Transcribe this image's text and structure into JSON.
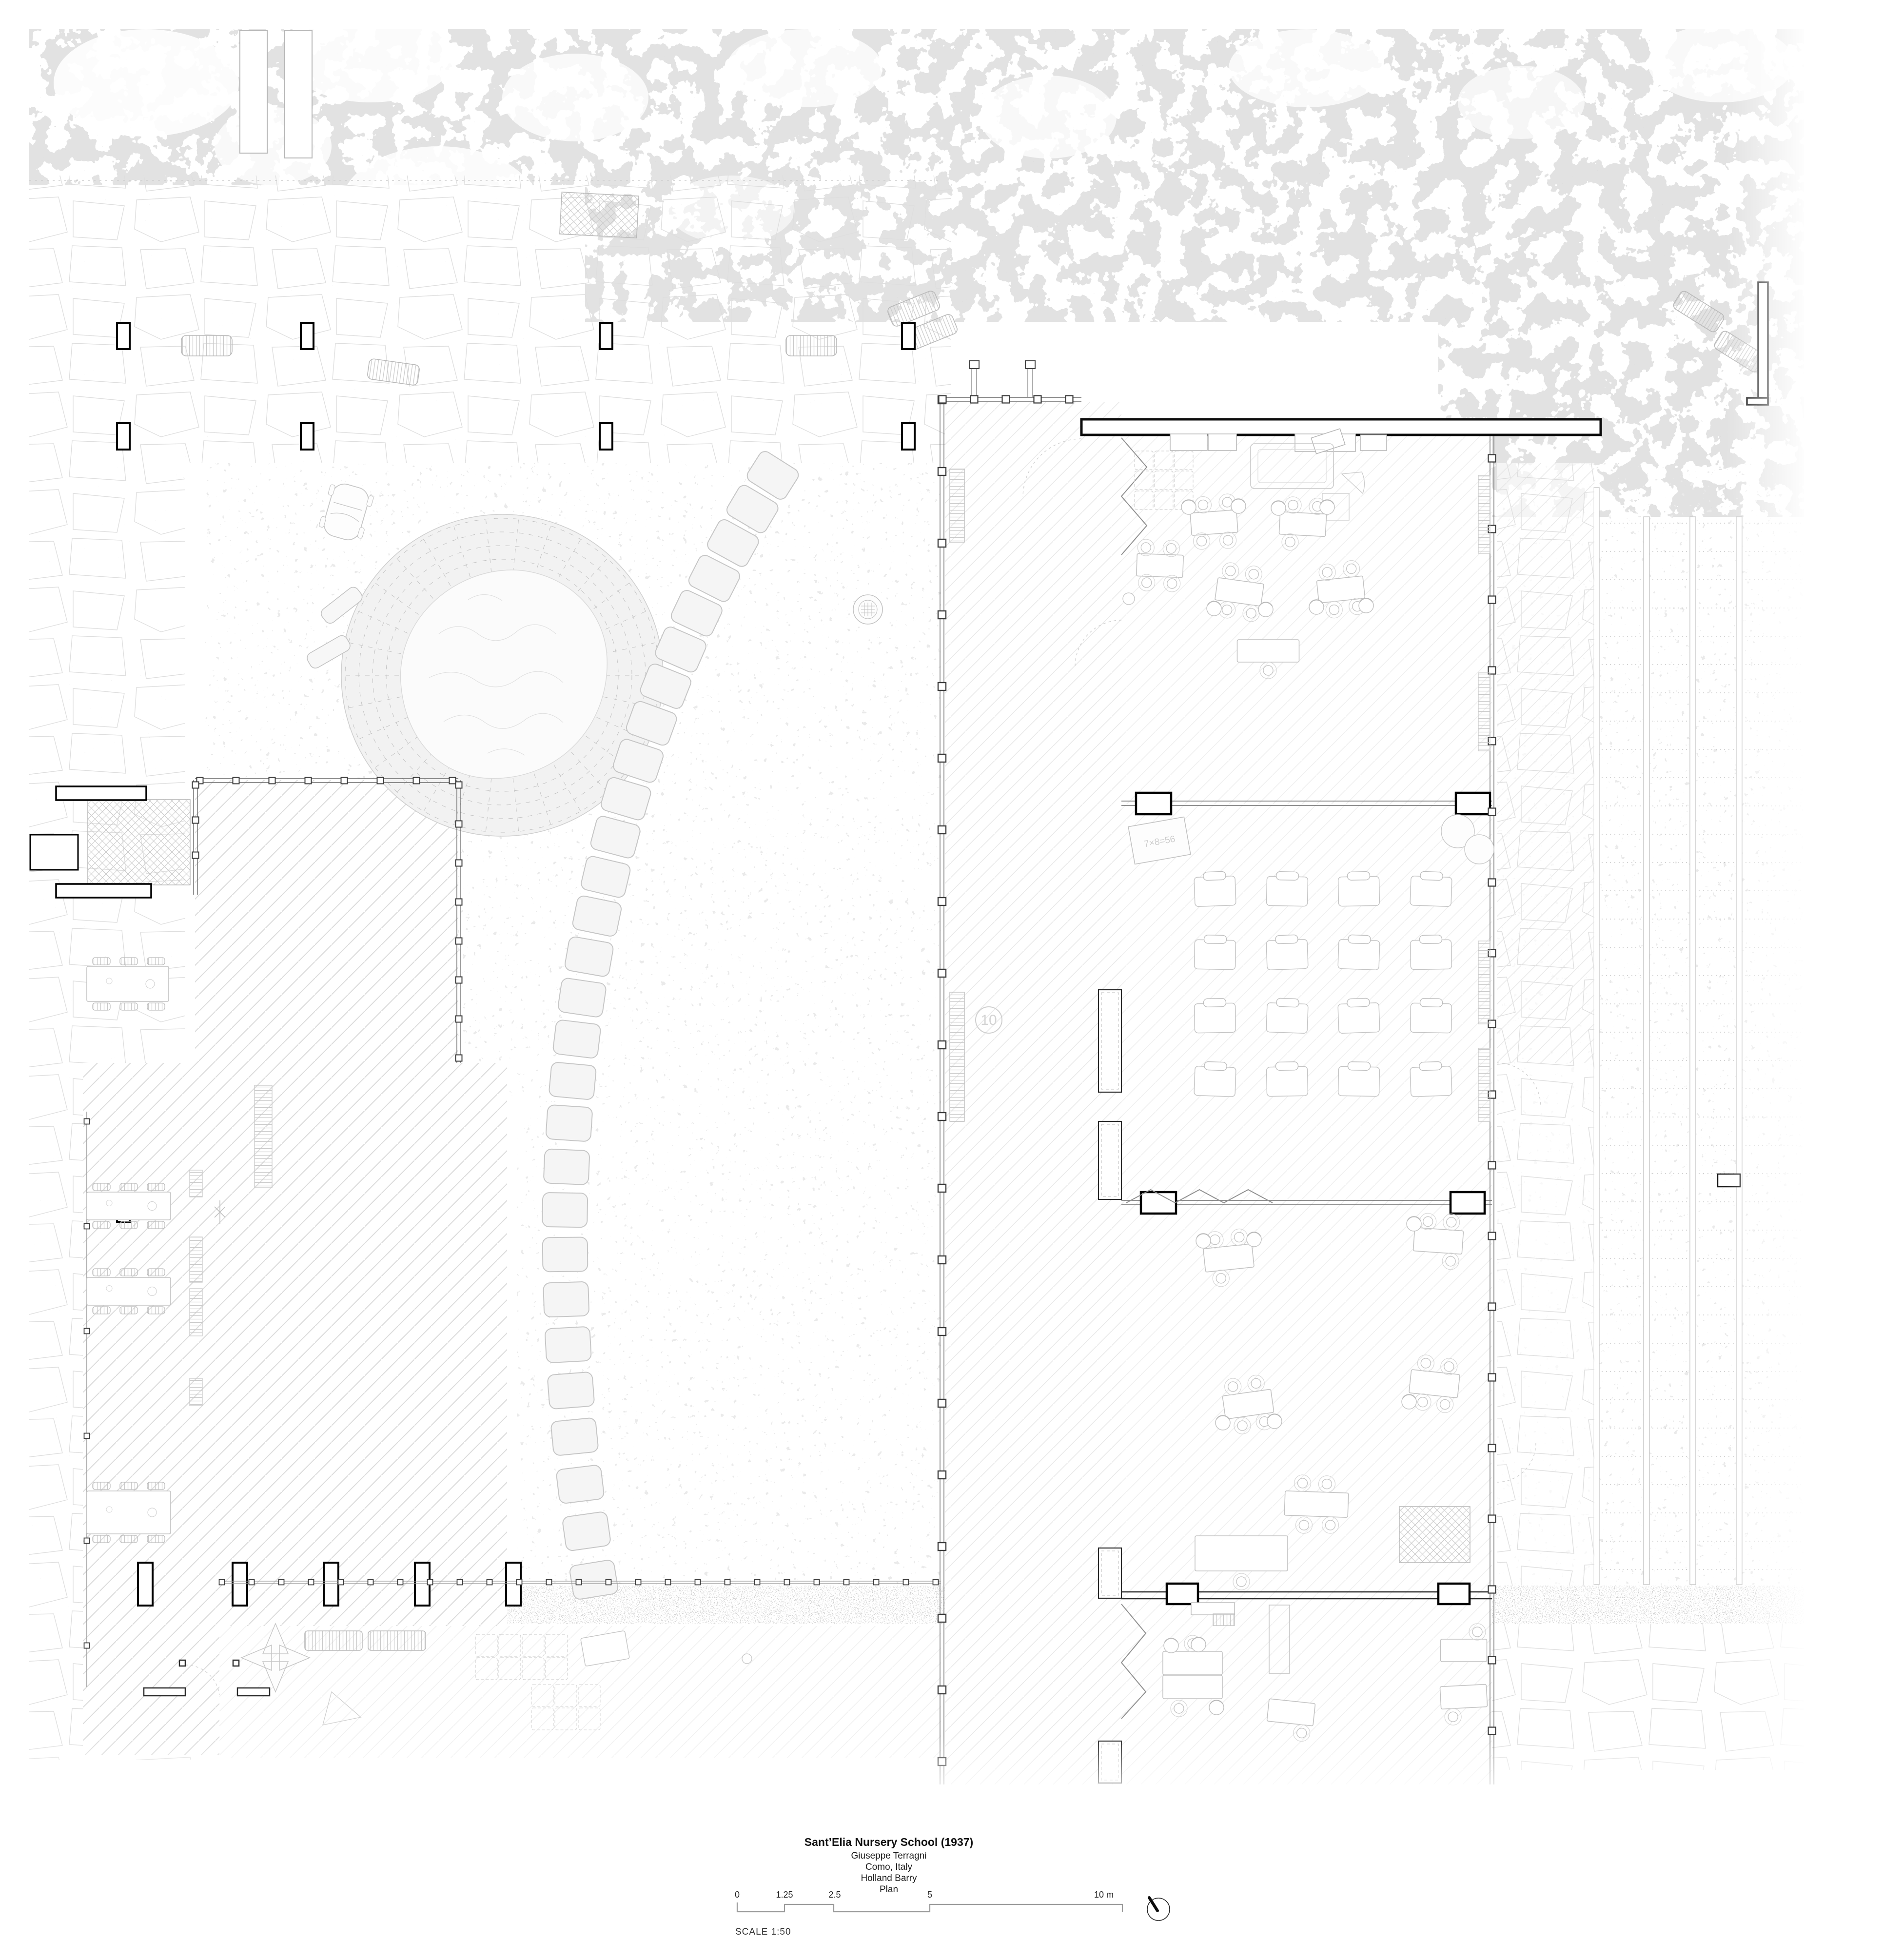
{
  "sheet": {
    "title_block": {
      "project": "Sant’Elia Nursery School (1937)",
      "architect": "Giuseppe Terragni",
      "location": "Como, Italy",
      "author": "Holland Barry",
      "drawing_type": "Plan"
    },
    "scale": {
      "note": "SCALE 1:50",
      "bar_labels": [
        "0",
        "1.25",
        "2.5",
        "5",
        "10 m"
      ]
    },
    "floor_markings": {
      "hopscotch_circle": "10",
      "hopscotch_squares": [
        "9",
        "8",
        "7",
        "6",
        "5",
        "4",
        "3",
        "2",
        "1"
      ],
      "chalkboard": "7×8=56"
    },
    "colors": {
      "paper": "#ffffff",
      "line_faint": "#d6d6d6",
      "line_medium": "#9a9a9a",
      "line_dark": "#1a1a1a"
    }
  }
}
